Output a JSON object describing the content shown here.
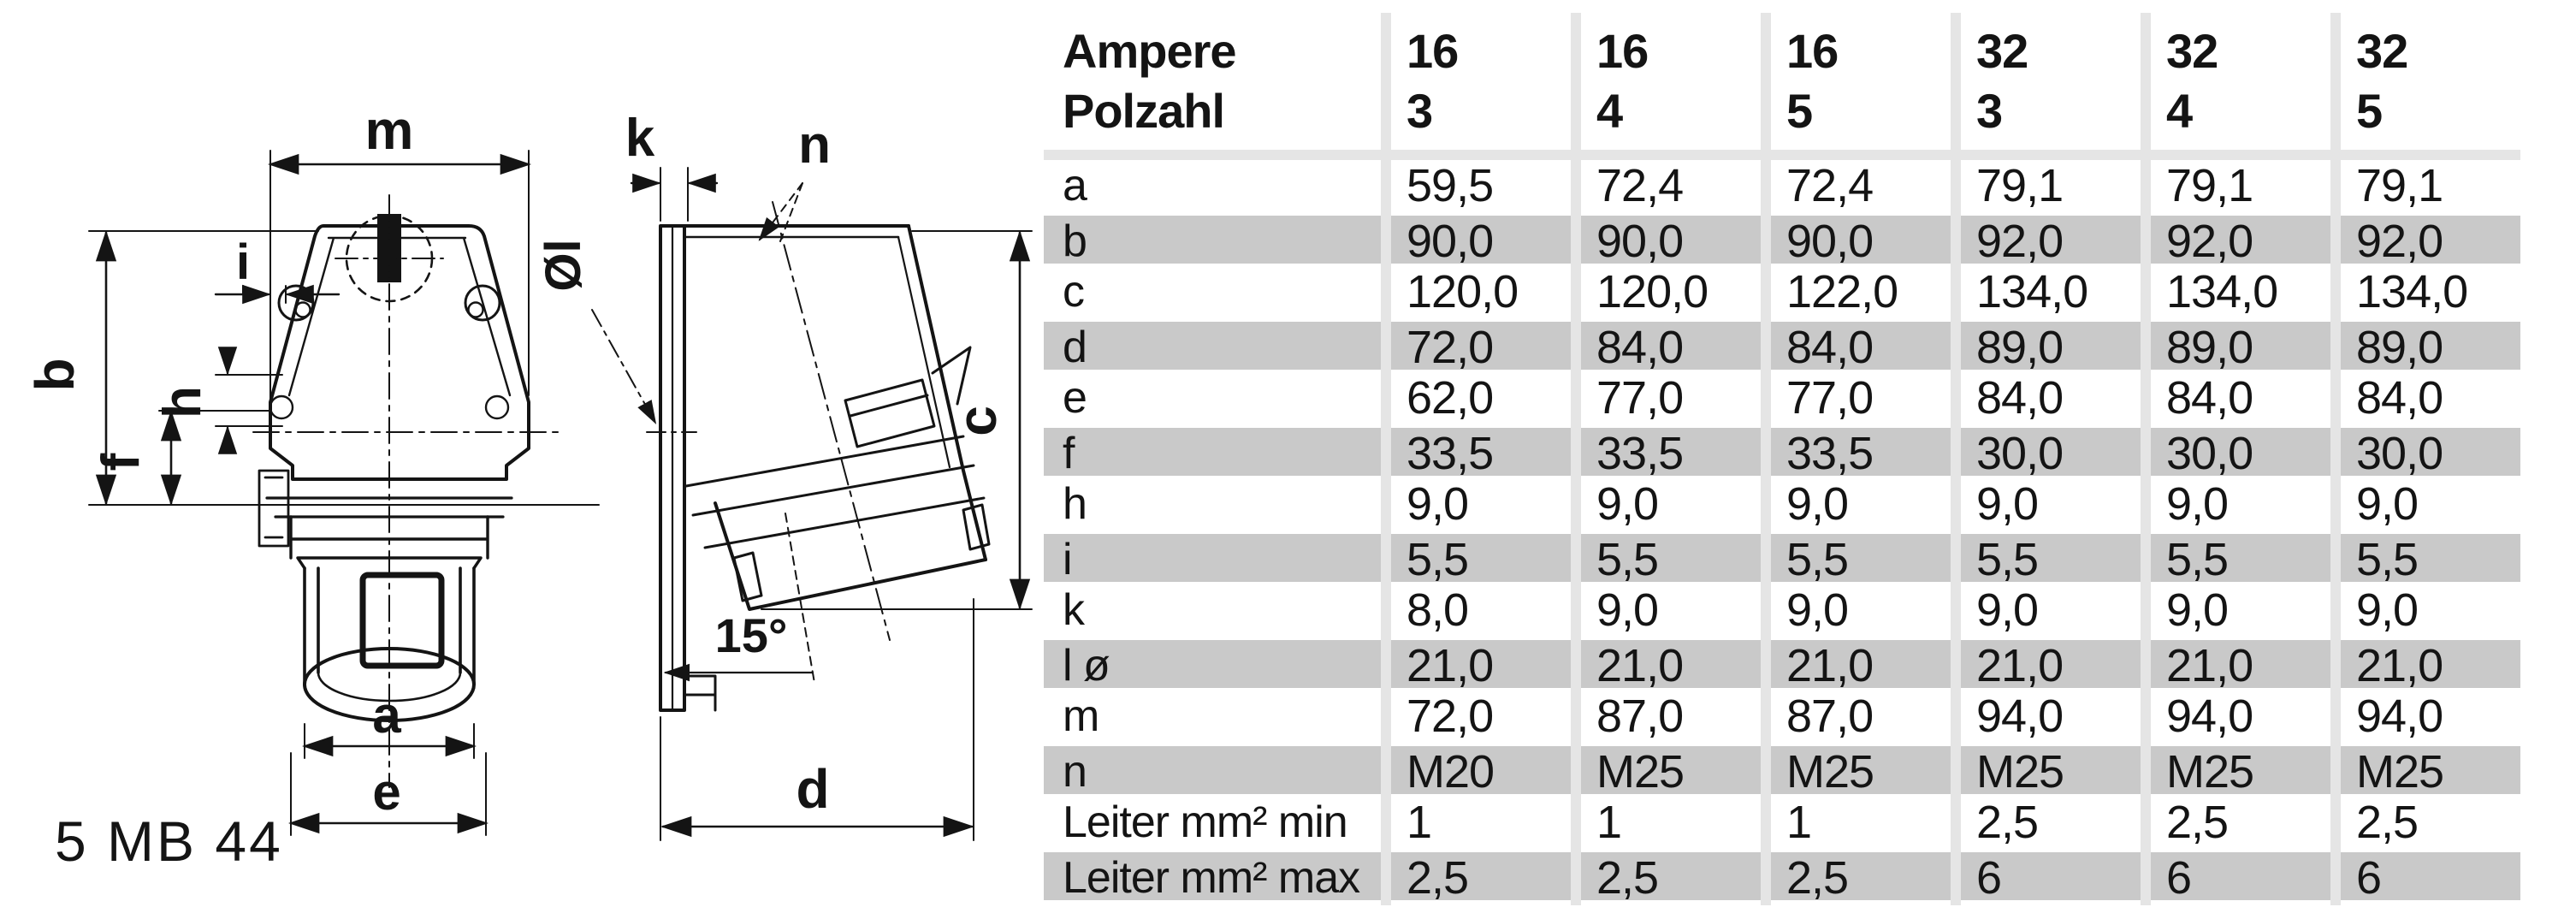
{
  "product_code": "5 MB 44",
  "drawing": {
    "front_view_labels": {
      "m": "m",
      "b": "b",
      "i": "i",
      "h": "h",
      "f": "f",
      "a": "a",
      "e": "e"
    },
    "side_view_labels": {
      "k": "k",
      "n": "n",
      "l_diameter": "Øl",
      "c": "c",
      "angle": "15°",
      "d": "d"
    }
  },
  "table": {
    "header_rows": [
      "Ampere",
      "Polzahl"
    ],
    "columns": [
      {
        "ampere": "16",
        "polzahl": "3"
      },
      {
        "ampere": "16",
        "polzahl": "4"
      },
      {
        "ampere": "16",
        "polzahl": "5"
      },
      {
        "ampere": "32",
        "polzahl": "3"
      },
      {
        "ampere": "32",
        "polzahl": "4"
      },
      {
        "ampere": "32",
        "polzahl": "5"
      }
    ],
    "rows": [
      {
        "label": "a",
        "values": [
          "59,5",
          "72,4",
          "72,4",
          "79,1",
          "79,1",
          "79,1"
        ]
      },
      {
        "label": "b",
        "values": [
          "90,0",
          "90,0",
          "90,0",
          "92,0",
          "92,0",
          "92,0"
        ]
      },
      {
        "label": "c",
        "values": [
          "120,0",
          "120,0",
          "122,0",
          "134,0",
          "134,0",
          "134,0"
        ]
      },
      {
        "label": "d",
        "values": [
          "72,0",
          "84,0",
          "84,0",
          "89,0",
          "89,0",
          "89,0"
        ]
      },
      {
        "label": "e",
        "values": [
          "62,0",
          "77,0",
          "77,0",
          "84,0",
          "84,0",
          "84,0"
        ]
      },
      {
        "label": "f",
        "values": [
          "33,5",
          "33,5",
          "33,5",
          "30,0",
          "30,0",
          "30,0"
        ]
      },
      {
        "label": "h",
        "values": [
          "9,0",
          "9,0",
          "9,0",
          "9,0",
          "9,0",
          "9,0"
        ]
      },
      {
        "label": "i",
        "values": [
          "5,5",
          "5,5",
          "5,5",
          "5,5",
          "5,5",
          "5,5"
        ]
      },
      {
        "label": "k",
        "values": [
          "8,0",
          "9,0",
          "9,0",
          "9,0",
          "9,0",
          "9,0"
        ]
      },
      {
        "label": "l ø",
        "values": [
          "21,0",
          "21,0",
          "21,0",
          "21,0",
          "21,0",
          "21,0"
        ]
      },
      {
        "label": "m",
        "values": [
          "72,0",
          "87,0",
          "87,0",
          "94,0",
          "94,0",
          "94,0"
        ]
      },
      {
        "label": "n",
        "values": [
          "M20",
          "M25",
          "M25",
          "M25",
          "M25",
          "M25"
        ]
      },
      {
        "label": "Leiter mm² min",
        "values": [
          "1",
          "1",
          "1",
          "2,5",
          "2,5",
          "2,5"
        ]
      },
      {
        "label": "Leiter mm² max",
        "values": [
          "2,5",
          "2,5",
          "2,5",
          "6",
          "6",
          "6"
        ]
      }
    ]
  },
  "colors": {
    "stripe": "#c9c9c9",
    "rule": "#e5e5e5",
    "ink": "#141414",
    "background": "#ffffff"
  }
}
